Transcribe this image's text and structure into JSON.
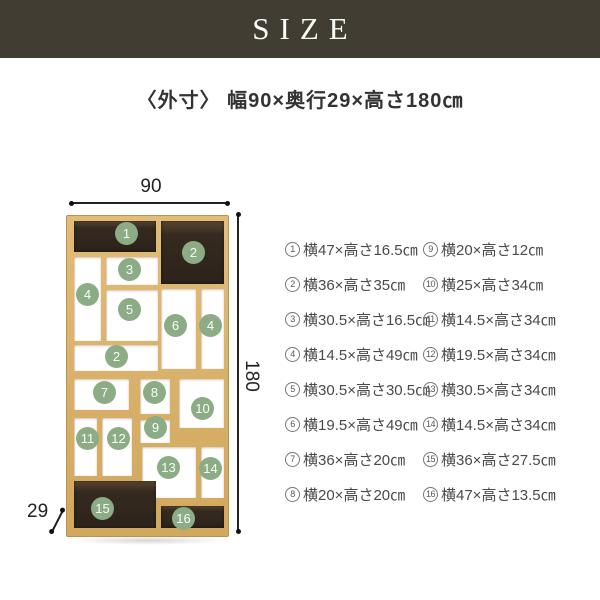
{
  "banner": {
    "title": "SIZE"
  },
  "subtitle": "〈外寸〉 幅90×奥行29×高さ180㎝",
  "diagram": {
    "width_label": "90",
    "height_label": "180",
    "depth_label": "29",
    "circles": [
      "1",
      "2",
      "3",
      "4",
      "5",
      "6",
      "4",
      "2",
      "7",
      "8",
      "9",
      "10",
      "11",
      "12",
      "13",
      "14",
      "15",
      "16"
    ]
  },
  "legend": {
    "col1": [
      {
        "num": "1",
        "text": "横47×高さ16.5㎝"
      },
      {
        "num": "2",
        "text": "横36×高さ35㎝"
      },
      {
        "num": "3",
        "text": "横30.5×高さ16.5㎝"
      },
      {
        "num": "4",
        "text": "横14.5×高さ49㎝"
      },
      {
        "num": "5",
        "text": "横30.5×高さ30.5㎝"
      },
      {
        "num": "6",
        "text": "横19.5×高さ49㎝"
      },
      {
        "num": "7",
        "text": "横36×高さ20㎝"
      },
      {
        "num": "8",
        "text": "横20×高さ20㎝"
      }
    ],
    "col2": [
      {
        "num": "9",
        "text": "横20×高さ12㎝"
      },
      {
        "num": "10",
        "text": "横25×高さ34㎝"
      },
      {
        "num": "11",
        "text": "横14.5×高さ34㎝"
      },
      {
        "num": "12",
        "text": "横19.5×高さ34㎝"
      },
      {
        "num": "13",
        "text": "横30.5×高さ34㎝"
      },
      {
        "num": "14",
        "text": "横14.5×高さ34㎝"
      },
      {
        "num": "15",
        "text": "横36×高さ27.5㎝"
      },
      {
        "num": "16",
        "text": "横47×高さ13.5㎝"
      }
    ]
  },
  "colors": {
    "banner_bg": "#413d33",
    "wood": "#d8b069",
    "dark_compartment": "#2e251d",
    "badge_green": "#8cac85",
    "text": "#4a4a4a"
  }
}
